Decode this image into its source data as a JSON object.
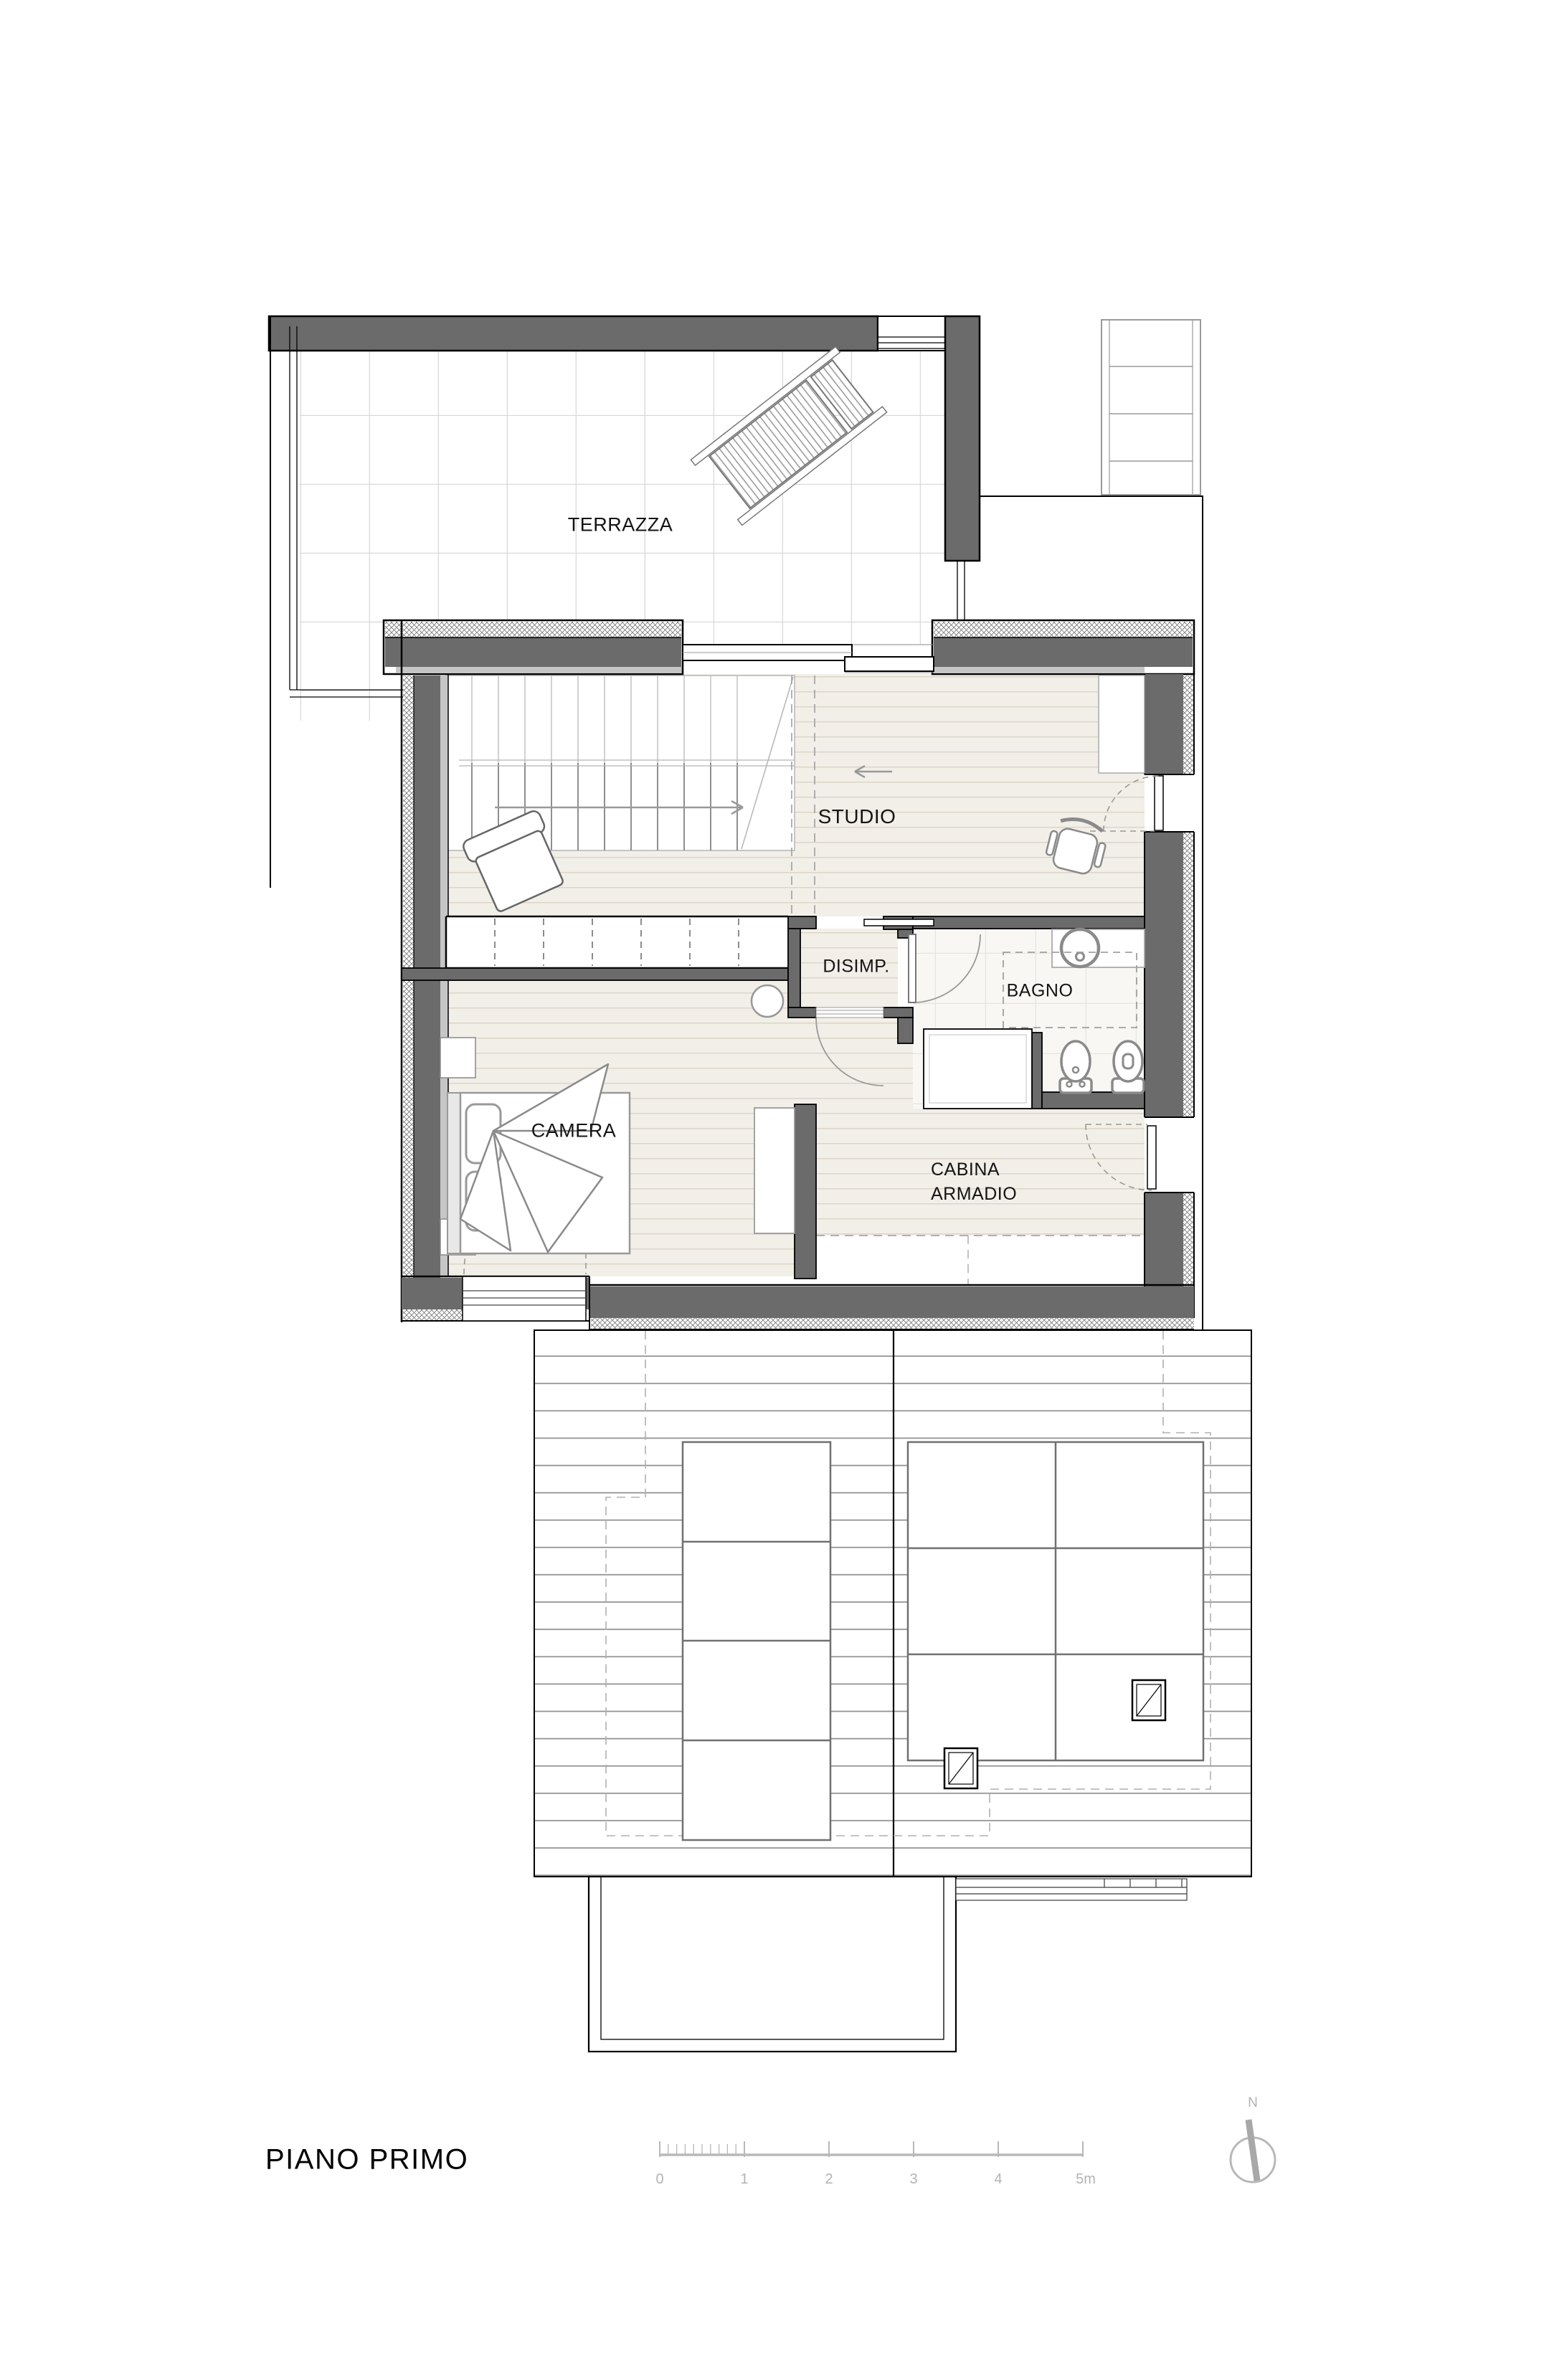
{
  "title": {
    "text": "PIANO PRIMO"
  },
  "rooms": {
    "terrazza": {
      "label": "TERRAZZA"
    },
    "studio": {
      "label": "STUDIO"
    },
    "disimpegno": {
      "label": "DISIMP."
    },
    "bagno": {
      "label": "BAGNO"
    },
    "camera": {
      "label": "CAMERA"
    },
    "cabina_armadio": {
      "line1": "CABINA",
      "line2": "ARMADIO"
    }
  },
  "scalebar": {
    "labels": [
      "0",
      "1",
      "2",
      "3",
      "4",
      "5m"
    ]
  },
  "compass": {
    "label": "N"
  },
  "colors": {
    "wall_fill": "#6b6b6b",
    "wall_outline": "#000000",
    "inner_finish": "#c6c6c6",
    "wood_floor": "#f2efe9",
    "wood_line": "#ddd5c7",
    "terrace_tile_line": "#d9d9d9",
    "bath_tile_line": "#e6e4df",
    "roof_line": "#909090",
    "furniture_stroke": "#8a8a8a",
    "annotation_grey": "#b3b3b3"
  }
}
